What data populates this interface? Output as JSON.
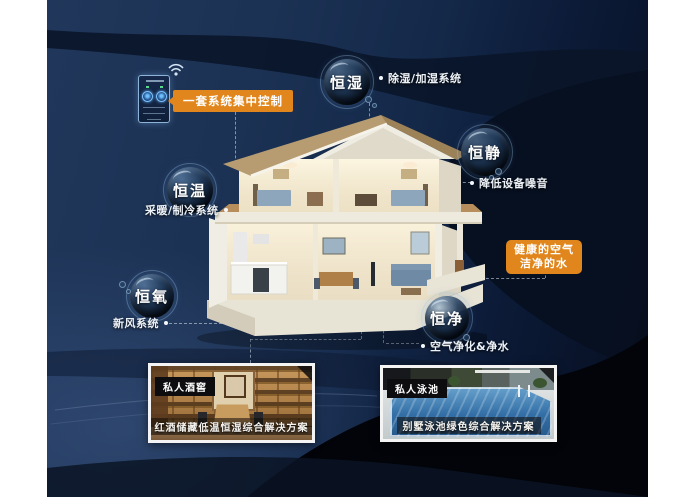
{
  "poster": {
    "control_panel": {
      "label": "一套系统集中控制"
    },
    "pillars": [
      {
        "label": "恒湿",
        "note": "除湿/加湿系统"
      },
      {
        "label": "恒静",
        "note": "降低设备噪音"
      },
      {
        "label": "恒温",
        "note": "采暖/制冷系统"
      },
      {
        "label": "恒氧",
        "note": "新风系统"
      },
      {
        "label": "恒净",
        "note": "空气净化&净水"
      }
    ],
    "highlight": {
      "line1": "健康的空气",
      "line2": "洁净的水"
    },
    "cards": [
      {
        "tag": "私人酒窖",
        "caption": "红酒储藏低温恒湿综合解决方案"
      },
      {
        "tag": "私人泳池",
        "caption": "别墅泳池绿色综合解决方案"
      }
    ],
    "colors": {
      "accent_orange": "#e0861c",
      "background_navy": "#1e3557",
      "deep_black": "#04070d",
      "bubble_rim": "#9cc2e0",
      "pool_water": "#3576ad",
      "cellar_wood": "#a97b43",
      "roof_tan": "#b79c72"
    }
  }
}
